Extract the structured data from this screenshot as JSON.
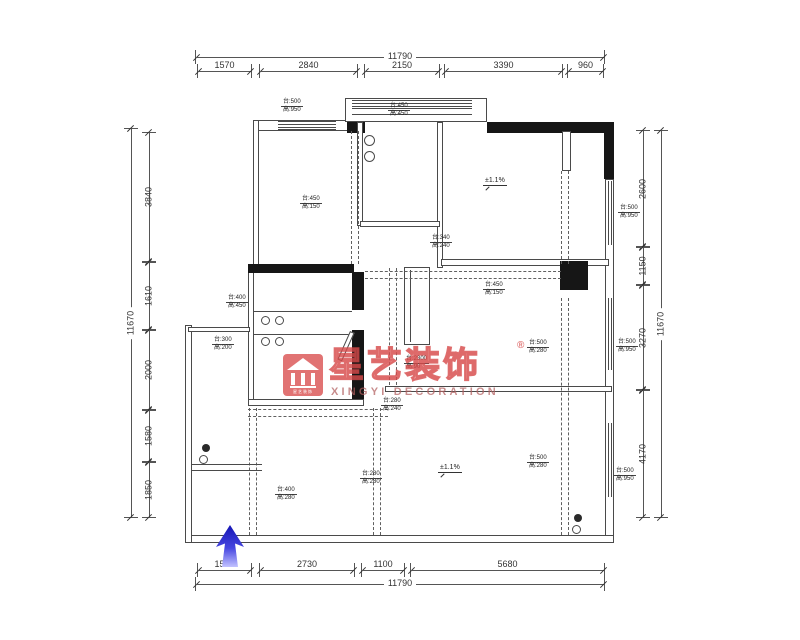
{
  "watermark": {
    "brand": "星艺装饰",
    "registered": "®",
    "subtitle": "XINGYI DECORATION",
    "logo_caption": "星艺装饰",
    "accent": "#d94a4a"
  },
  "dims": {
    "top": {
      "total": "11790",
      "segs": [
        "1570",
        "2840",
        "2150",
        "3390",
        "960"
      ]
    },
    "bottom": {
      "total": "11790",
      "segs": [
        "1570",
        "2730",
        "1100",
        "5680"
      ]
    },
    "left": {
      "total": "11670",
      "segs": [
        "3840",
        "1610",
        "2000",
        "1580",
        "1850"
      ]
    },
    "right": {
      "total": "11670",
      "segs": [
        "2600",
        "1150",
        "3270",
        "4170"
      ]
    }
  },
  "levels": [
    "±1.1%",
    "±1.1%"
  ],
  "annotations": [
    {
      "l1": "台:500",
      "l2": "高:950"
    },
    {
      "l1": "台:450",
      "l2": "高:450"
    },
    {
      "l1": "台:450",
      "l2": "高:150"
    },
    {
      "l1": "台:340",
      "l2": "高:240"
    },
    {
      "l1": "台:450",
      "l2": "高:150"
    },
    {
      "l1": "台:500",
      "l2": "高:280"
    },
    {
      "l1": "台:280",
      "l2": "高:240"
    },
    {
      "l1": "台:500",
      "l2": "高:280"
    },
    {
      "l1": "台:400",
      "l2": "高:450"
    },
    {
      "l1": "台:300",
      "l2": "高:200"
    },
    {
      "l1": "台:400",
      "l2": "高:280"
    },
    {
      "l1": "台:280",
      "l2": "高:280"
    },
    {
      "l1": "台:2300",
      "l2": "高:90"
    },
    {
      "l1": "台:500",
      "l2": "高:950"
    },
    {
      "l1": "台:500",
      "l2": "高:950"
    },
    {
      "l1": "台:500",
      "l2": "高:950"
    }
  ]
}
